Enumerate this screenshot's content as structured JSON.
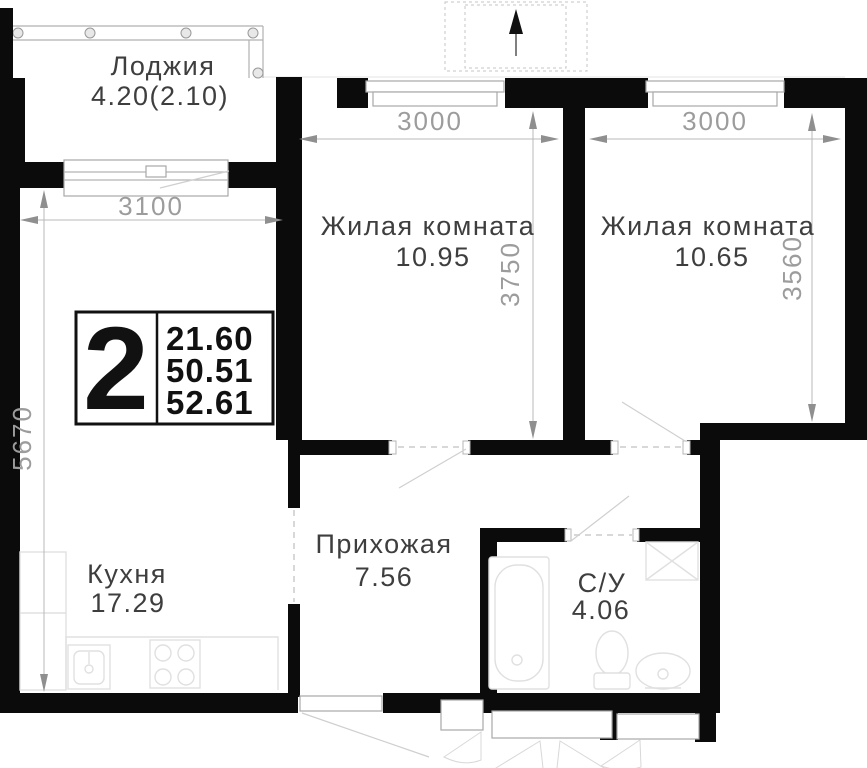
{
  "badge": {
    "room_count": "2",
    "area_lines": [
      "21.60",
      "50.51",
      "52.61"
    ]
  },
  "rooms": {
    "loggia": {
      "name": "Лоджия",
      "area": "4.20(2.10)"
    },
    "living1": {
      "name": "Жилая комната",
      "area": "10.95"
    },
    "living2": {
      "name": "Жилая комната",
      "area": "10.65"
    },
    "kitchen": {
      "name": "Кухня",
      "area": "17.29"
    },
    "hallway": {
      "name": "Прихожая",
      "area": "7.56"
    },
    "bathroom": {
      "name": "С/У",
      "area": "4.06"
    }
  },
  "dimensions": {
    "loggia_width": "3100",
    "left_height": "5670",
    "living1_width": "3000",
    "living1_height": "3750",
    "living2_width": "3000",
    "living2_height": "3560"
  },
  "icons": {
    "north_arrow": "up-arrow",
    "fixtures": [
      "bathtub",
      "toilet",
      "wash-basin",
      "washing-machine",
      "kitchen-sink",
      "stove"
    ]
  },
  "colors": {
    "wall": "#0b0b0b",
    "dim": "#9c9c9c",
    "label": "#3e3e3e",
    "fixture": "#e0e0e0",
    "door": "#cfcfcf",
    "glazing": "#b0b0b0"
  }
}
